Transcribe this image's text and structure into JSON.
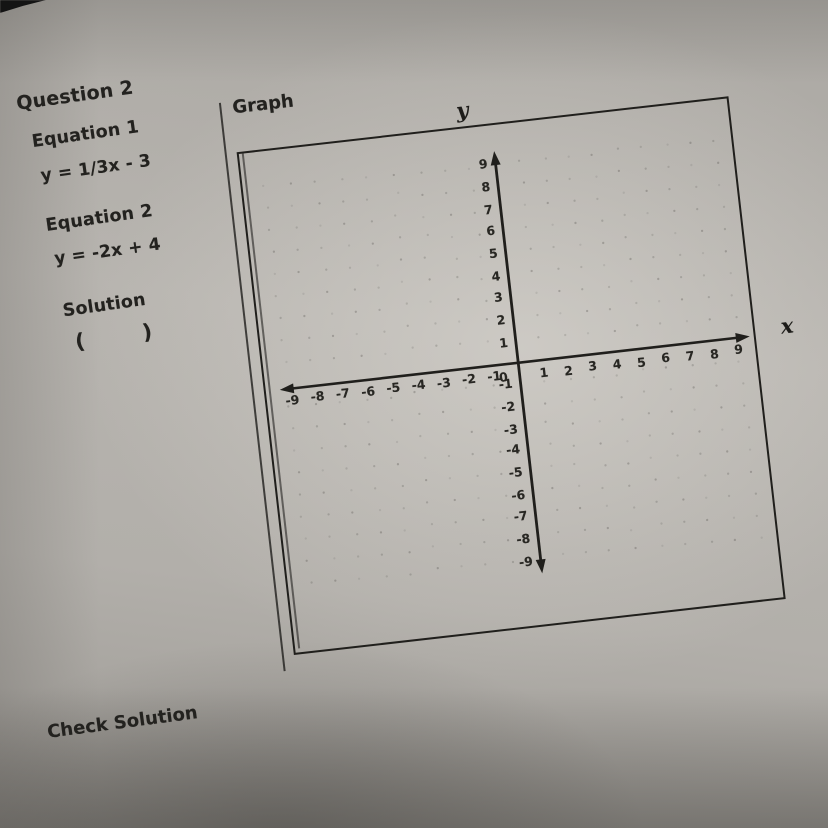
{
  "question": {
    "title": "Question 2"
  },
  "equations": [
    {
      "label": "Equation 1",
      "formula": "y = 1/3x - 3"
    },
    {
      "label": "Equation 2",
      "formula": "y = -2x + 4"
    }
  ],
  "solution": {
    "label": "Solution",
    "open_paren": "(",
    "close_paren": ")"
  },
  "check": {
    "label": "Check Solution"
  },
  "graph": {
    "section_label": "Graph",
    "x_label": "x",
    "y_label": "y",
    "origin_label": "0",
    "x_ticks": [
      -9,
      -8,
      -7,
      -6,
      -5,
      -4,
      -3,
      -2,
      -1,
      1,
      2,
      3,
      4,
      5,
      6,
      7,
      8,
      9
    ],
    "y_ticks": [
      9,
      8,
      7,
      6,
      5,
      4,
      3,
      2,
      1,
      -1,
      -2,
      -3,
      -4,
      -5,
      -6,
      -7,
      -8,
      -9
    ]
  },
  "chart_data": {
    "type": "scatter",
    "title": "Graph",
    "xlabel": "x",
    "ylabel": "y",
    "xlim": [
      -9.5,
      9.5
    ],
    "ylim": [
      -9.5,
      9.5
    ],
    "x_tick_labels": [
      -9,
      -8,
      -7,
      -6,
      -5,
      -4,
      -3,
      -2,
      -1,
      0,
      1,
      2,
      3,
      4,
      5,
      6,
      7,
      8,
      9
    ],
    "y_tick_labels": [
      -9,
      -8,
      -7,
      -6,
      -5,
      -4,
      -3,
      -2,
      -1,
      0,
      1,
      2,
      3,
      4,
      5,
      6,
      7,
      8,
      9
    ],
    "grid": "dot-lattice",
    "legend": "none",
    "series": [],
    "note": "Empty hand-drawn coordinate plane; no lines plotted yet"
  },
  "colors": {
    "paper": "#b2afaa",
    "ink": "#201f1c"
  }
}
